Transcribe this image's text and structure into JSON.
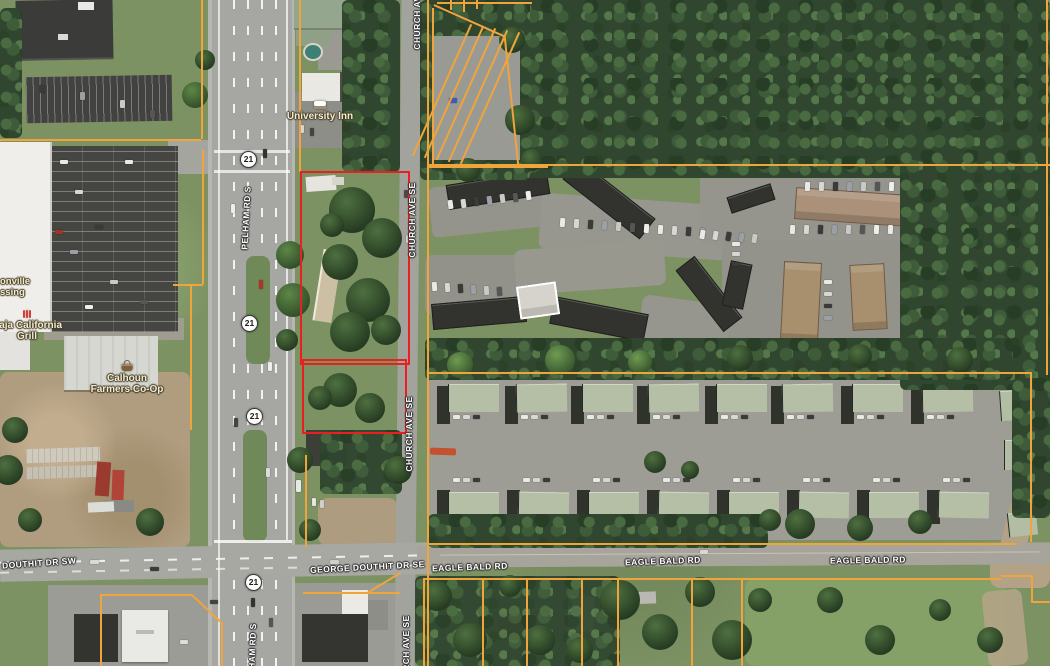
{
  "map": {
    "type": "satellite-parcel-view",
    "highlight_color": "#e82020",
    "parcel_line_color": "#f0a43c",
    "road_labels": [
      {
        "id": "pelham-top",
        "text": "PELHAM RD S"
      },
      {
        "id": "pelham-bottom",
        "text": "PELHAM RD S"
      },
      {
        "id": "church-1",
        "text": "CHURCH AVE SE"
      },
      {
        "id": "church-2",
        "text": "CHURCH AVE SE"
      },
      {
        "id": "church-3",
        "text": "CHURCH AVE SE"
      },
      {
        "id": "church-4",
        "text": "CHURCH AVE SE"
      },
      {
        "id": "douthit-sw",
        "text": "DOUTHIT DR SW"
      },
      {
        "id": "george-douthit",
        "text": "GEORGE DOUTHIT DR SE"
      },
      {
        "id": "eagle-1",
        "text": "EAGLE BALD RD"
      },
      {
        "id": "eagle-2",
        "text": "EAGLE BALD RD"
      },
      {
        "id": "eagle-3",
        "text": "EAGLE BALD RD"
      }
    ],
    "route_shields": [
      {
        "text": "21"
      },
      {
        "text": "21"
      },
      {
        "text": "21"
      },
      {
        "text": "21"
      }
    ],
    "poi_labels": [
      {
        "id": "university-inn",
        "lines": [
          "University Inn"
        ],
        "icon": "bed-icon"
      },
      {
        "id": "jacksonville-crossing",
        "lines": [
          "onville",
          "ssing"
        ]
      },
      {
        "id": "baja-california-grill",
        "lines": [
          "Baja California",
          "Grill"
        ],
        "icon": "restaurant-icon"
      },
      {
        "id": "calhoun-farmers-coop",
        "lines": [
          "Calhoun",
          "Farmers Co-Op"
        ],
        "icon": "shopping-basket-icon"
      }
    ]
  }
}
